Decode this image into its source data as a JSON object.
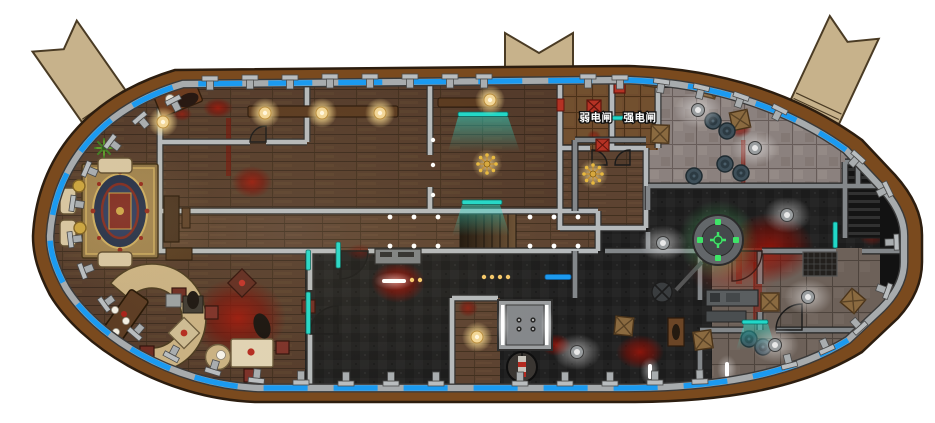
{
  "map": {
    "type": "ship-floorplan",
    "labels": {
      "weak_switch": "弱电闸",
      "strong_switch": "强电闸"
    },
    "colors": {
      "background": "#ffffff",
      "hull": "#7a4a1e",
      "hull_outline": "#2c1d0f",
      "inner_wall": "#a7abad",
      "window_blue": "#1b9af0",
      "gangway": "#c7b28b",
      "gangway_edge": "#4a3b24",
      "wood_floor": "#543b2b",
      "wood_floor_light": "#5d4331",
      "dark_floor": "#212121",
      "stone_tile": "#8b817e",
      "stone_tile_dark": "#6d6159",
      "wood_tile": "#6f4c2e",
      "wall_light": "#b5b9bb",
      "wall_dark": "#83878a",
      "blood": "#8f1008",
      "lamp_warm": "#f6dc9c",
      "lamp_white": "#ffffff",
      "holo_cyan": "#22d8c8",
      "reactor_green": "#3fe468",
      "crate": "#8a6a40",
      "barrel": "#3e4f59",
      "rug_navy": "#1c2947",
      "rug_gold": "#c9a95e",
      "rug_red": "#7a231c",
      "sofa": "#d6c5a2",
      "bar": "#c9b183",
      "counter": "#5a3a22",
      "table_red": "#6e2b22",
      "elevator": "#9b9ea0",
      "switch_box_red": "#b53224"
    },
    "features": [
      "gangway-top-left",
      "gangway-top-center",
      "gangway-top-right",
      "lounge-rug",
      "sofa-set",
      "bar-counter",
      "saloon-tables",
      "dining-long-table",
      "wall-lamps",
      "holo-screens",
      "chandeliers",
      "stairs-center",
      "weak-switch-room",
      "strong-switch-room",
      "cargo-crates",
      "barrels",
      "reactor",
      "engine-room",
      "elevator",
      "spiral-stair",
      "blood-stains",
      "corpse-figures",
      "perimeter-windows"
    ]
  }
}
